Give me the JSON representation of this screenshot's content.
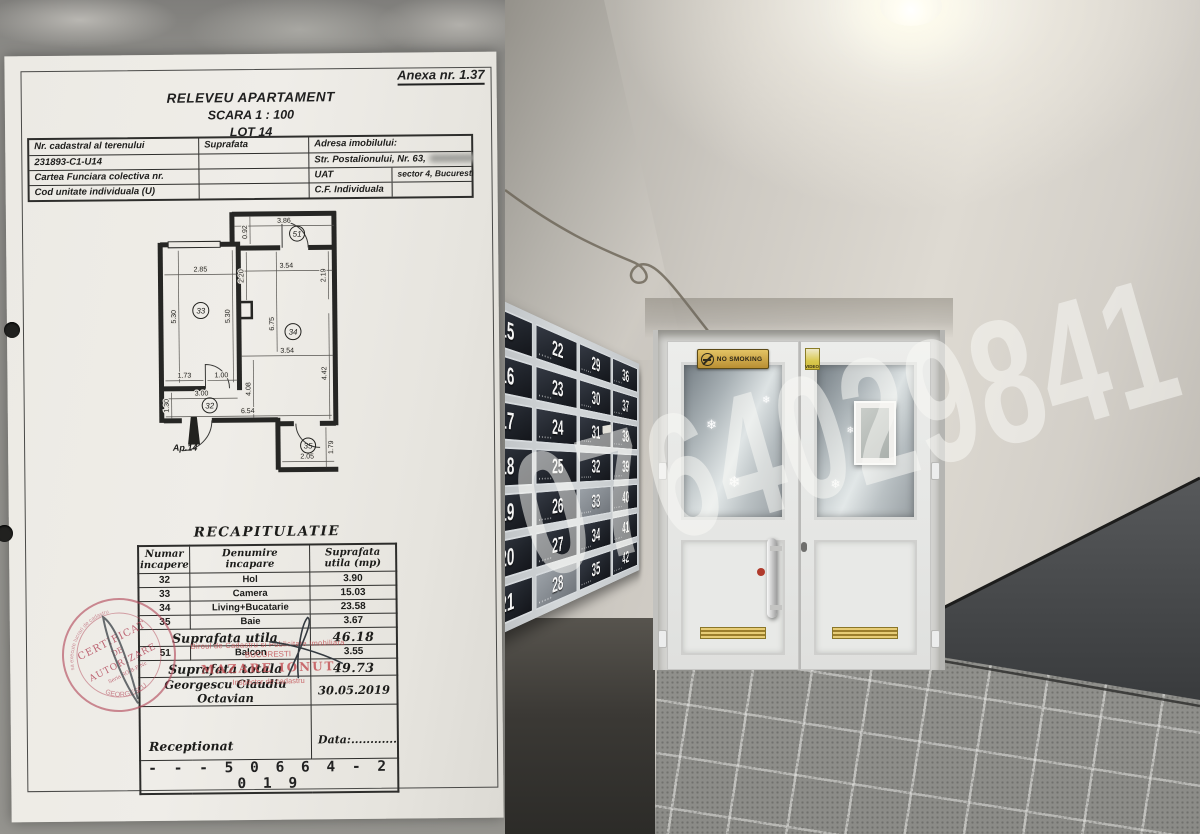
{
  "document": {
    "annex": "Anexa nr. 1.37",
    "title": "RELEVEU APARTAMENT",
    "scale": "SCARA 1 : 100",
    "lot": "LOT 14",
    "info": {
      "col1_header": "Nr. cadastral al terenului",
      "col2_header": "Suprafata",
      "col3_header": "Adresa imobilului:",
      "cadastral_number": "231893-C1-U14",
      "address": "Str. Postalionului, Nr. 63,",
      "carte_funciara_label": "Cartea Funciara colectiva nr.",
      "uat_label": "UAT",
      "uat_value": "sector 4, Bucuresti",
      "cod_unitate_label": "Cod unitate individuala (U)",
      "cf_label": "C.F. Individuala"
    },
    "floorplan": {
      "apartment_label": "Ap.14",
      "rooms": {
        "r51": "51",
        "r33": "33",
        "r34": "34",
        "r32": "32",
        "r35": "35"
      },
      "dims": {
        "balcony_w": "3.86",
        "balcony_d": "0.92",
        "r33_w": "2.85",
        "r33_hl": "5.30",
        "r33_hr": "5.30",
        "r34_w1": "3.54",
        "r34_l1": "2.20",
        "r34_r1": "2.19",
        "r34_h": "6.75",
        "r34_w2": "3.54",
        "r34_l2": "4.08",
        "r34_r2": "4.42",
        "hall_a": "1.73",
        "hall_b": "1.00",
        "hall_w": "3.00",
        "hall_h": "1.30",
        "span": "6.54",
        "bath_w": "2.05",
        "bath_h": "1.79"
      }
    },
    "recap": {
      "title": "RECAPITULATIE",
      "headers": {
        "c1a": "Numar",
        "c1b": "incapere",
        "c2a": "Denumire",
        "c2b": "incapare",
        "c3a": "Suprafata",
        "c3b": "utila  (mp)"
      },
      "rows": [
        [
          "32",
          "Hol",
          "3.90"
        ],
        [
          "33",
          "Camera",
          "15.03"
        ],
        [
          "34",
          "Living+Bucatarie",
          "23.58"
        ],
        [
          "35",
          "Baie",
          "3.67"
        ]
      ],
      "subtotal_label": "Suprafata  utila",
      "subtotal_value": "46.18",
      "balcony_row": [
        "51",
        "Balcon",
        "3.55"
      ],
      "total_label": "Suprafata  totala",
      "total_value": "49.73",
      "surveyor": "Georgescu  Claudiu  Octavian",
      "survey_date": "30.05.2019",
      "received_label": "Receptionat",
      "data_label": "Data:............",
      "registration_number": "- - - 5 0 6 6 4 - 2 0 1 9"
    },
    "office_stamp": {
      "line1": "Biroul de Cadastru si Publicitate Imobiliara",
      "line2": "BUCURESTI",
      "inspector": "MAZARE IONUT",
      "role": "Inspector de cadastru"
    },
    "round_stamp": {
      "line1": "CERTIFICAT",
      "line2": "DE",
      "line3": "AUTORIZARE",
      "series": "Seria RO-B-F Nr.",
      "name": "GEORGESCU",
      "edge": "sa execute lucrari de cadastru"
    }
  },
  "photo": {
    "watermark": "0764029841",
    "no_smoking_sign": "NO SMOKING",
    "video_sticker": "VIDEO",
    "mailboxes": {
      "columns": [
        [
          "15",
          "16",
          "17",
          "18",
          "19",
          "20",
          "21"
        ],
        [
          "22",
          "23",
          "24",
          "25",
          "26",
          "27",
          "28"
        ],
        [
          "29",
          "30",
          "31",
          "32",
          "33",
          "34",
          "35"
        ],
        [
          "36",
          "37",
          "38",
          "39",
          "40",
          "41",
          "42"
        ]
      ],
      "light_boxes": [
        "28",
        "33"
      ],
      "flyer_box": "31"
    }
  }
}
